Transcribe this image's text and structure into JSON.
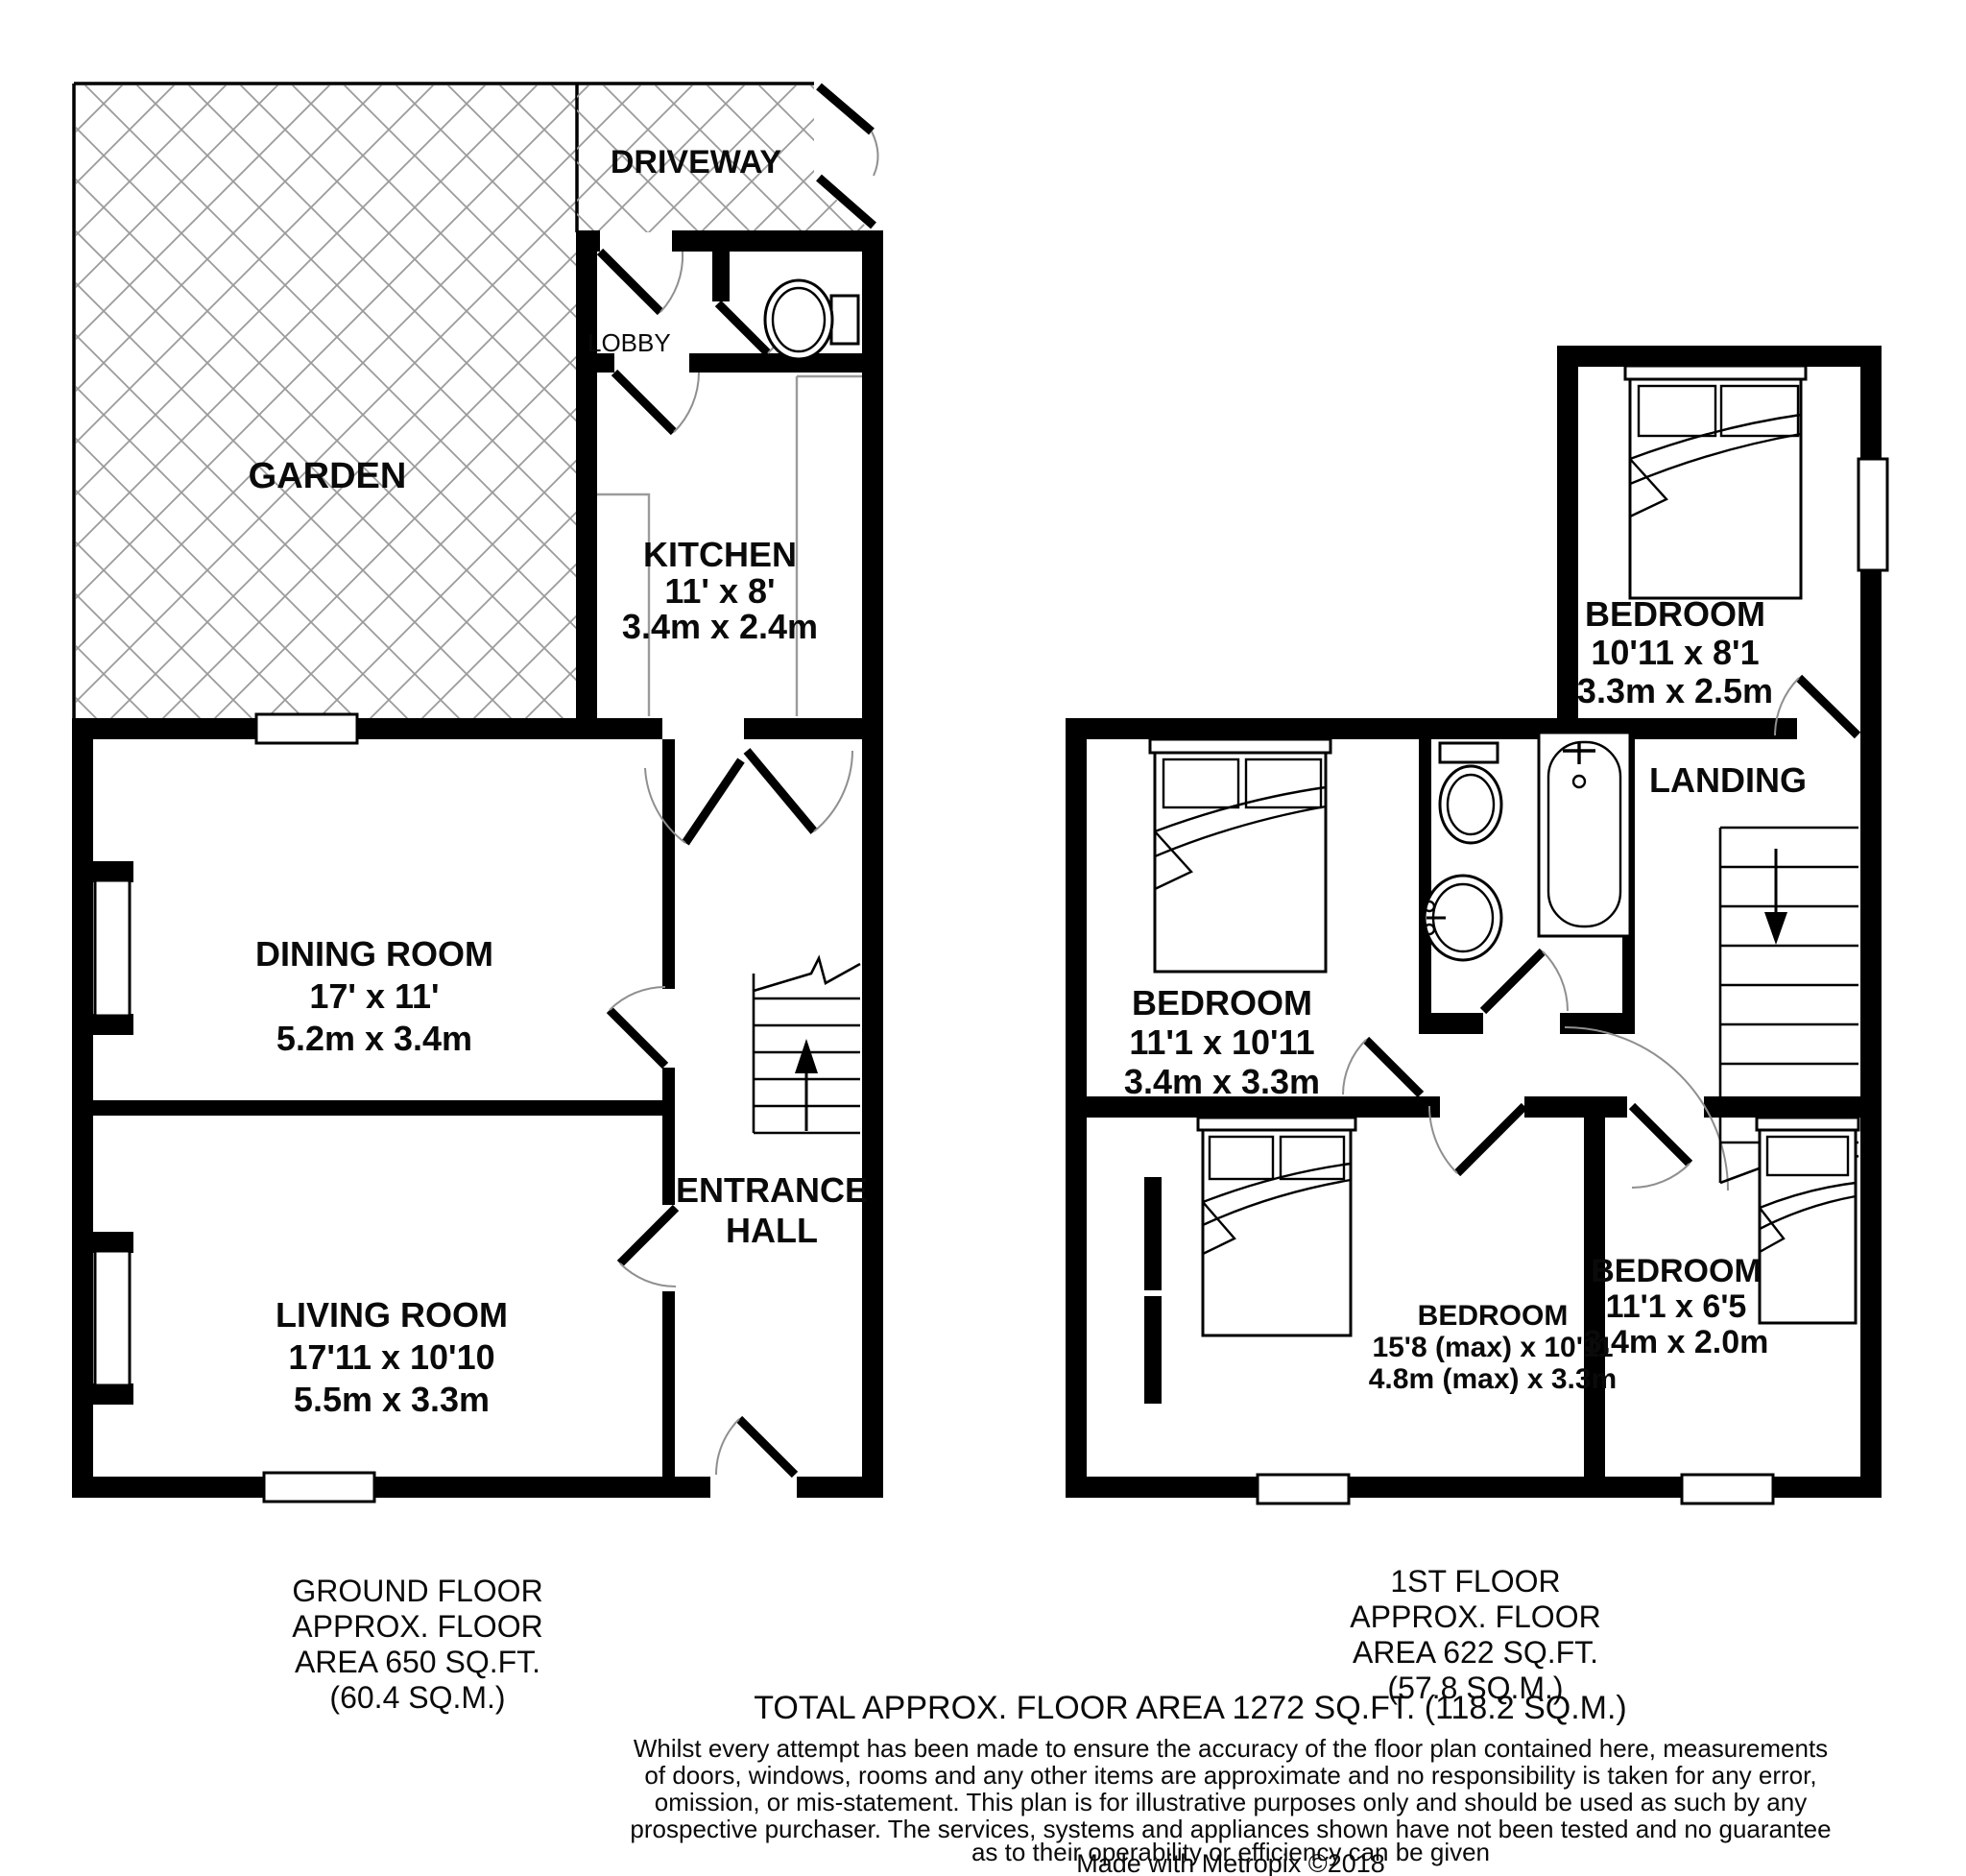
{
  "plan": {
    "ground_floor": {
      "caption": [
        "GROUND FLOOR",
        "APPROX. FLOOR",
        "AREA 650 SQ.FT.",
        "(60.4 SQ.M.)"
      ],
      "labels": {
        "garden": "GARDEN",
        "driveway": "DRIVEWAY",
        "lobby": "LOBBY",
        "kitchen": {
          "name": "KITCHEN",
          "imperial": "11' x 8'",
          "metric": "3.4m x 2.4m"
        },
        "dining": {
          "name": "DINING ROOM",
          "imperial": "17' x 11'",
          "metric": "5.2m x 3.4m"
        },
        "living": {
          "name": "LIVING ROOM",
          "imperial": "17'11 x 10'10",
          "metric": "5.5m x 3.3m"
        },
        "hall": {
          "line1": "ENTRANCE",
          "line2": "HALL"
        }
      }
    },
    "first_floor": {
      "caption": [
        "1ST FLOOR",
        "APPROX. FLOOR",
        "AREA 622 SQ.FT.",
        "(57.8 SQ.M.)"
      ],
      "labels": {
        "landing": "LANDING",
        "bedroom_top": {
          "name": "BEDROOM",
          "imperial": "10'11 x 8'1",
          "metric": "3.3m x 2.5m"
        },
        "bedroom_left": {
          "name": "BEDROOM",
          "imperial": "11'1 x 10'11",
          "metric": "3.4m x 3.3m"
        },
        "bedroom_back": {
          "name": "BEDROOM",
          "imperial": "15'8 (max) x 10'11",
          "metric": "4.8m (max) x 3.3m"
        },
        "bedroom_small": {
          "name": "BEDROOM",
          "imperial": "11'1 x 6'5",
          "metric": "3.4m x 2.0m"
        }
      }
    },
    "footer": {
      "total": "TOTAL APPROX. FLOOR AREA 1272 SQ.FT. (118.2 SQ.M.)",
      "disclaimer": [
        "Whilst every attempt has been made to ensure the accuracy of the floor plan contained here, measurements",
        "of doors, windows, rooms and any other items are approximate and no responsibility is taken for any error,",
        "omission, or mis-statement. This plan is for illustrative purposes only and should be used as such by any",
        "prospective purchaser. The services, systems and appliances shown have not been tested and no guarantee",
        "as to their operability or efficiency can be given"
      ],
      "credit": "Made with Metropix ©2018"
    },
    "colors": {
      "wall": "#000000",
      "hatch": "#9b9b9b",
      "door_arc": "#8f8f8f"
    }
  }
}
